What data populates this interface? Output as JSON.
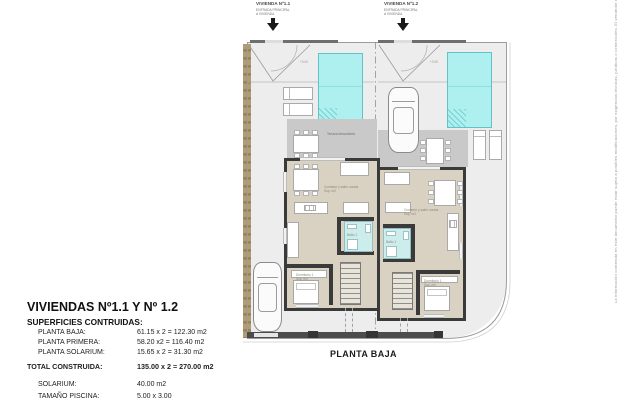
{
  "header": {
    "unit1": {
      "title": "VIVIENDA Nº1.1",
      "sub1": "ENTRADA PRINCIPAL",
      "sub2": "A VIVIENDA"
    },
    "unit2": {
      "title": "VIVIENDA Nº1.2",
      "sub1": "ENTRADA PRINCIPAL",
      "sub2": "A VIVIENDA"
    }
  },
  "plan": {
    "caption": "PLANTA BAJA",
    "levels": {
      "left": "+0.00",
      "right": "+0.00"
    },
    "rooms": {
      "terrace1": "Terraza descubierta",
      "living1": "Comedor y salón cocina",
      "living1_sup": "Sup. m2",
      "living2": "Comedor y salón cocina",
      "living2_sup": "Sup. m2",
      "bed1": "Dormitorio 1",
      "bed1_sup": "Sup. m2",
      "bed2": "Dormitorio 1",
      "bed2_sup": "Sup. m2",
      "bath1": "Baño 1",
      "bath2": "Baño 1"
    }
  },
  "summary": {
    "title": "VIVIENDAS Nº1.1 Y Nº 1.2",
    "subtitle": "SUPERFICIES CONTRUIDAS:",
    "rows": [
      {
        "label": "PLANTA BAJA:",
        "value": "61.15 x 2 = 122.30 m2"
      },
      {
        "label": "PLANTA PRIMERA:",
        "value": "58.20 x2 = 116.40 m2"
      },
      {
        "label": "PLANTA SOLARIUM:",
        "value": "15.65 x 2 = 31.30 m2"
      }
    ],
    "total": {
      "label": "TOTAL CONSTRUIDA:",
      "value": "135.00 x 2 = 270.00 m2"
    },
    "extras": [
      {
        "label": "SOLARIUM:",
        "value": "40.00 m2"
      },
      {
        "label": "TAMAÑO PISCINA:",
        "value": "5.00 x 3.00"
      }
    ]
  },
  "disclaimer": "La información contenida en este documento puede estar sujeta a posibles modificaciones, por exigencias técnicas, jurídicas o comerciales. El vendedor reflejará en contrato el estado definitivo.",
  "colors": {
    "pool": "#aeeff0",
    "terrace": "#c9c9c9",
    "floor": "#d9d2c3",
    "wall": "#3a3a3a",
    "hedge": "#b49b72",
    "ground": "#ededed",
    "bathroom": "#cdecec",
    "fence": "#4c4c4a",
    "arrow": "#1a1a1a"
  }
}
